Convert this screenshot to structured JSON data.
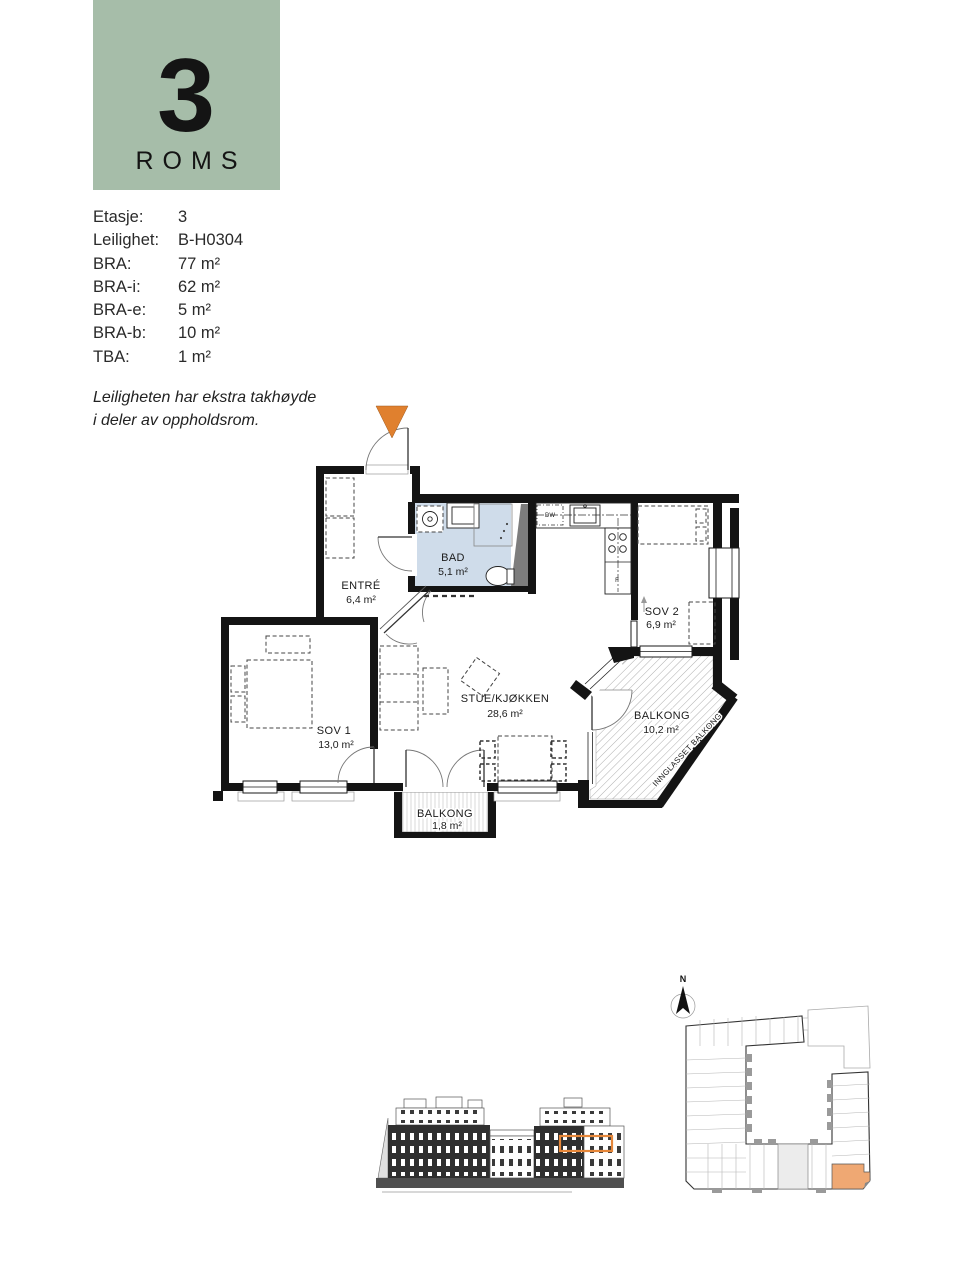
{
  "badge": {
    "number": "3",
    "label": "ROMS"
  },
  "details": {
    "rows": [
      {
        "label": "Etasje:",
        "value": "3"
      },
      {
        "label": "Leilighet:",
        "value": "B-H0304"
      },
      {
        "label": "BRA:",
        "value": "77 m²"
      },
      {
        "label": "BRA-i:",
        "value": "62 m²"
      },
      {
        "label": "BRA-e:",
        "value": "5 m²"
      },
      {
        "label": "BRA-b:",
        "value": "10 m²"
      },
      {
        "label": "TBA:",
        "value": "1 m²"
      }
    ]
  },
  "note": {
    "line1": "Leiligheten har ekstra takhøyde",
    "line2": "i deler av oppholdsrom."
  },
  "floorplan": {
    "rooms": {
      "entre": {
        "name": "ENTRÉ",
        "area": "6,4 m²"
      },
      "bad": {
        "name": "BAD",
        "area": "5,1 m²"
      },
      "sov1": {
        "name": "SOV 1",
        "area": "13,0 m²"
      },
      "sov2": {
        "name": "SOV 2",
        "area": "6,9 m²"
      },
      "stue": {
        "name": "STUE/KJØKKEN",
        "area": "28,6 m²"
      },
      "balkong": {
        "name": "BALKONG",
        "area": "10,2 m²"
      },
      "balkong2": {
        "name": "BALKONG",
        "area": "1,8 m²"
      }
    },
    "balcony_note": "INNGLASSET BALKONG",
    "appliances": {
      "dishwasher": "DW",
      "fridge": "F"
    }
  },
  "siteplan": {
    "north_label": "N"
  },
  "colors": {
    "badge_green": "#a6bda9",
    "bath_blue": "#cfdcea",
    "marker_orange": "#e0802e",
    "unit_orange": "#efa873",
    "highlight_orange": "#e6873a",
    "wall_black": "#141414"
  }
}
